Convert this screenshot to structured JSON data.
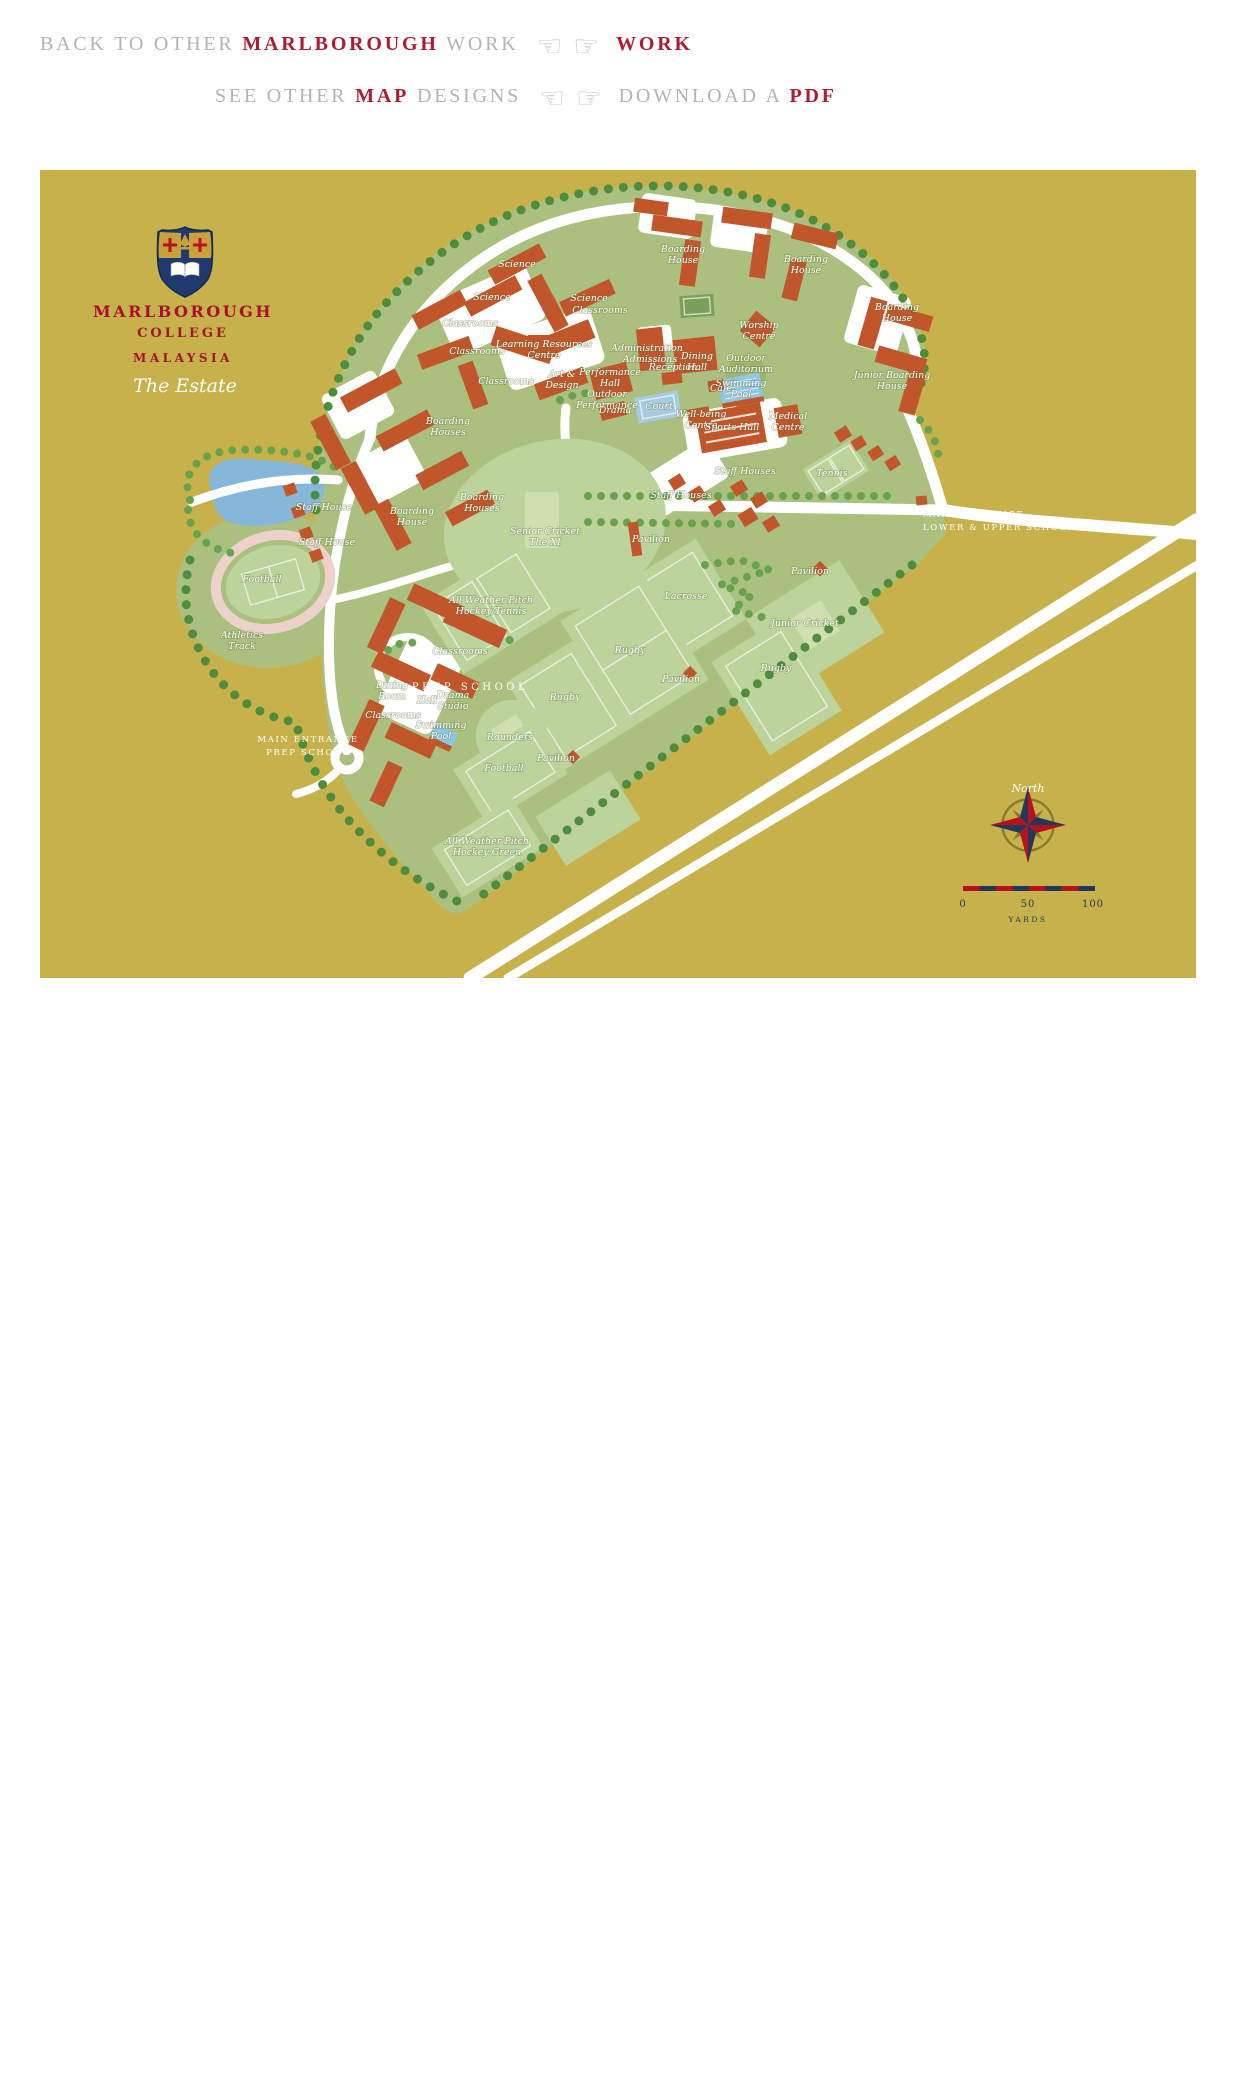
{
  "nav": {
    "colors": {
      "gray": "#b3b3b3",
      "red": "#ae1c33"
    },
    "line1": {
      "segments": [
        {
          "text": "BACK TO OTHER ",
          "style": "gray"
        },
        {
          "text": "MARLBOROUGH",
          "style": "red"
        },
        {
          "text": " WORK",
          "style": "gray"
        }
      ],
      "icons": [
        {
          "name": "left-pointing-hand",
          "glyph": "☜"
        },
        {
          "name": "right-pointing-hand",
          "glyph": "☞"
        }
      ],
      "link": [
        {
          "text": "WORK",
          "style": "red"
        }
      ]
    },
    "line2": {
      "segments": [
        {
          "text": "SEE OTHER ",
          "style": "gray"
        },
        {
          "text": "MAP",
          "style": "red"
        },
        {
          "text": " DESIGNS",
          "style": "gray"
        }
      ],
      "icons": [
        {
          "name": "left-pointing-hand",
          "glyph": "☜"
        },
        {
          "name": "right-pointing-hand",
          "glyph": "☞"
        }
      ],
      "link": [
        {
          "text": "DOWNLOAD A ",
          "style": "gray"
        },
        {
          "text": "PDF",
          "style": "red"
        }
      ]
    }
  },
  "map": {
    "colors": {
      "gold": "#c6b14b",
      "green": "#abc07e",
      "field": "#bdd39c",
      "field2": "#cfdfb0",
      "bldg": "#c2562b",
      "lake": "#86b7d9",
      "pool": "#8ec7e6",
      "court": "#a9cbe0",
      "track": "#ecd2ca",
      "tree": "#4e8c3e",
      "tree2": "#67a34e",
      "navy": "#23375a",
      "accentred": "#b5121b",
      "titlered": "#a8112e",
      "crestnavy": "#1f3b6e",
      "crestgold": "#c9a03c"
    },
    "title": {
      "line1": "MARLBOROUGH",
      "line2": "COLLEGE",
      "line3": "MALAYSIA",
      "subtitle": "The Estate"
    },
    "compass": {
      "label": "North"
    },
    "scale": {
      "ticks": [
        "0",
        "50",
        "100"
      ],
      "unit": "YARDS"
    },
    "labels": [
      {
        "t": "MARLBOROUGH",
        "x": 143,
        "y": 147,
        "s": "t1"
      },
      {
        "t": "COLLEGE",
        "x": 143,
        "y": 167,
        "s": "t2"
      },
      {
        "t": "MALAYSIA",
        "x": 143,
        "y": 192,
        "s": "t3"
      },
      {
        "t": "The Estate",
        "x": 145,
        "y": 222,
        "s": "est"
      },
      {
        "t": "Science",
        "x": 477,
        "y": 97
      },
      {
        "t": "Science",
        "x": 452,
        "y": 130
      },
      {
        "t": "Science",
        "x": 549,
        "y": 131
      },
      {
        "t": "Classrooms",
        "x": 430,
        "y": 156
      },
      {
        "t": "Classrooms",
        "x": 437,
        "y": 184
      },
      {
        "t": "Classrooms",
        "x": 560,
        "y": 143
      },
      {
        "t": "Classrooms",
        "x": 466,
        "y": 214
      },
      {
        "t": "Learning Resources|Centre",
        "x": 504,
        "y": 177
      },
      {
        "t": "Art &|Design",
        "x": 522,
        "y": 207
      },
      {
        "t": "Boarding|House",
        "x": 643,
        "y": 82
      },
      {
        "t": "Boarding|House",
        "x": 766,
        "y": 92
      },
      {
        "t": "Boarding|House",
        "x": 857,
        "y": 140
      },
      {
        "t": "Junior Boarding|House",
        "x": 852,
        "y": 208
      },
      {
        "t": "Boarding|Houses",
        "x": 408,
        "y": 254
      },
      {
        "t": "Boarding|Houses",
        "x": 442,
        "y": 330
      },
      {
        "t": "Boarding|House",
        "x": 372,
        "y": 344
      },
      {
        "t": "Administration",
        "x": 607,
        "y": 181
      },
      {
        "t": "Admissions",
        "x": 610,
        "y": 192
      },
      {
        "t": "Reception",
        "x": 633,
        "y": 200
      },
      {
        "t": "Dining|Hall",
        "x": 657,
        "y": 189
      },
      {
        "t": "Worship|Centre",
        "x": 719,
        "y": 158
      },
      {
        "t": "Outdoor|Auditorium",
        "x": 706,
        "y": 191
      },
      {
        "t": "Performance|Hall",
        "x": 570,
        "y": 205
      },
      {
        "t": "Outdoor|Performance",
        "x": 567,
        "y": 227
      },
      {
        "t": "Drama",
        "x": 575,
        "y": 243
      },
      {
        "t": "Court",
        "x": 619,
        "y": 239
      },
      {
        "t": "Café",
        "x": 681,
        "y": 221
      },
      {
        "t": "Swimming|Pool",
        "x": 701,
        "y": 216
      },
      {
        "t": "Well-being|Centre",
        "x": 661,
        "y": 247
      },
      {
        "t": "Sports Hall",
        "x": 692,
        "y": 260
      },
      {
        "t": "Medical|Centre",
        "x": 748,
        "y": 249
      },
      {
        "t": "Staff House",
        "x": 284,
        "y": 340
      },
      {
        "t": "Staff House",
        "x": 287,
        "y": 375
      },
      {
        "t": "Staff Houses",
        "x": 641,
        "y": 328
      },
      {
        "t": "Staff Houses",
        "x": 705,
        "y": 304
      },
      {
        "t": "Tennis",
        "x": 792,
        "y": 306
      },
      {
        "t": "Pavilion",
        "x": 611,
        "y": 372
      },
      {
        "t": "Pavilion",
        "x": 770,
        "y": 404
      },
      {
        "t": "Pavilion",
        "x": 641,
        "y": 512
      },
      {
        "t": "Pavilion",
        "x": 516,
        "y": 591
      },
      {
        "t": "Senior Cricket|The XI",
        "x": 505,
        "y": 364
      },
      {
        "t": "All Weather Pitch|Hockey/Tennis",
        "x": 451,
        "y": 433
      },
      {
        "t": "Lacrosse",
        "x": 646,
        "y": 429
      },
      {
        "t": "Rugby",
        "x": 590,
        "y": 483
      },
      {
        "t": "Rugby",
        "x": 736,
        "y": 501
      },
      {
        "t": "Rugby",
        "x": 525,
        "y": 530
      },
      {
        "t": "Junior Cricket",
        "x": 765,
        "y": 456
      },
      {
        "t": "Rounders",
        "x": 470,
        "y": 570
      },
      {
        "t": "Football",
        "x": 222,
        "y": 412
      },
      {
        "t": "Athletics|Track",
        "x": 202,
        "y": 468
      },
      {
        "t": "Football",
        "x": 464,
        "y": 601
      },
      {
        "t": "All Weather Pitch|Hockey Green",
        "x": 447,
        "y": 674
      },
      {
        "t": "Dining|Room",
        "x": 352,
        "y": 518
      },
      {
        "t": "Hall",
        "x": 387,
        "y": 533
      },
      {
        "t": "Drama|Studio",
        "x": 413,
        "y": 528
      },
      {
        "t": "Swimming|Pool",
        "x": 401,
        "y": 558
      },
      {
        "t": "Classrooms",
        "x": 420,
        "y": 484
      },
      {
        "t": "Classrooms",
        "x": 353,
        "y": 548
      },
      {
        "t": "PREP SCHOOL",
        "x": 430,
        "y": 520,
        "s": "ps"
      },
      {
        "t": "MAIN ENTRANCE|LOWER & UPPER SCHOOL",
        "x": 883,
        "y": 347,
        "s": "c"
      },
      {
        "t": "MAIN ENTRANCE|PREP SCHOOL",
        "x": 268,
        "y": 572,
        "s": "c2"
      },
      {
        "t": "North",
        "x": 988,
        "y": 622,
        "s": "north"
      },
      {
        "t": "0",
        "x": 923,
        "y": 737,
        "s": "num"
      },
      {
        "t": "50",
        "x": 988,
        "y": 737,
        "s": "num"
      },
      {
        "t": "100",
        "x": 1053,
        "y": 737,
        "s": "num"
      },
      {
        "t": "YARDS",
        "x": 988,
        "y": 752,
        "s": "yards"
      }
    ]
  }
}
